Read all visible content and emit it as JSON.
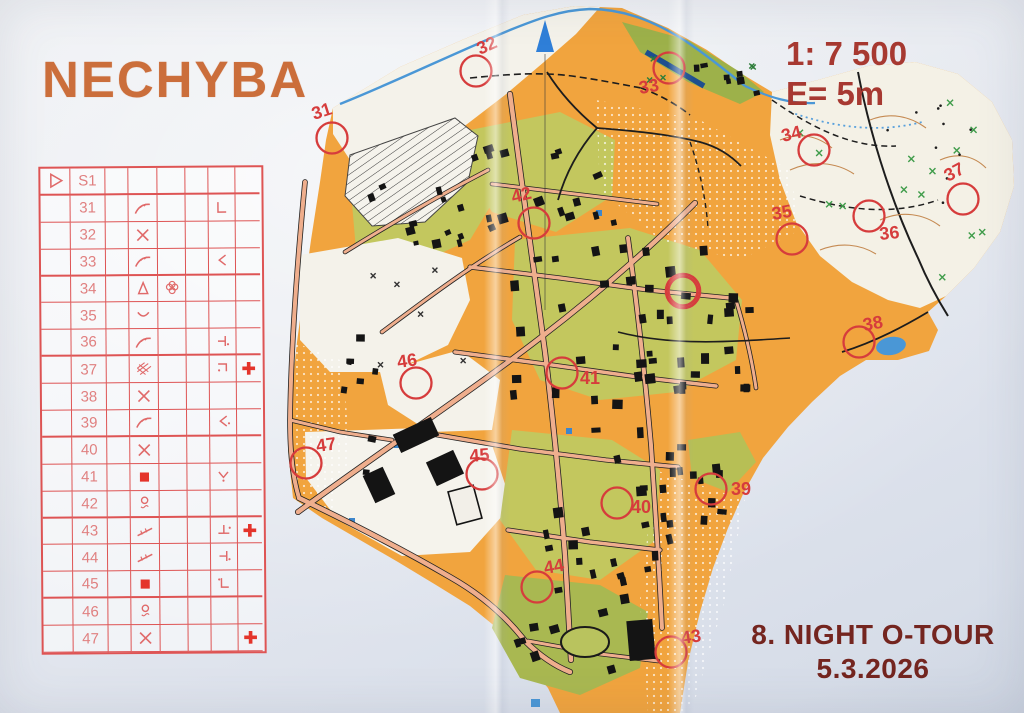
{
  "title": "NECHYBA",
  "map_info": {
    "scale": "1: 7 500",
    "contour_interval": "E= 5m"
  },
  "event": {
    "line1": "8. NIGHT O-TOUR",
    "line2": "5.3.2026"
  },
  "colors": {
    "course": "#d63c3c",
    "title": "#cb6e3b",
    "scale_text": "#a73931",
    "event_text": "#74251f",
    "sheet": "#de5454",
    "water": "#4a97d6"
  },
  "control_card": {
    "start_code": "S1",
    "start_symbol": "start-triangle",
    "rows": [
      {
        "no": "31",
        "sym_d": "earth-bank",
        "sym_e": "",
        "sym_g": "corner",
        "sym_h": ""
      },
      {
        "no": "32",
        "sym_d": "crossing",
        "sym_e": "",
        "sym_g": "",
        "sym_h": ""
      },
      {
        "no": "33",
        "sym_d": "earth-bank",
        "sym_e": "",
        "sym_g": "angle-left",
        "sym_h": ""
      },
      {
        "no": "34",
        "sym_d": "knoll",
        "sym_e": "copse",
        "sym_g": "",
        "sym_h": ""
      },
      {
        "no": "35",
        "sym_d": "depression",
        "sym_e": "",
        "sym_g": "",
        "sym_h": ""
      },
      {
        "no": "36",
        "sym_d": "earth-bank",
        "sym_e": "",
        "sym_g": "tbar-dot",
        "sym_h": ""
      },
      {
        "no": "37",
        "sym_d": "crosshatch",
        "sym_e": "",
        "sym_g": "corner-top-dot",
        "sym_h": "first-aid"
      },
      {
        "no": "38",
        "sym_d": "crossing",
        "sym_e": "",
        "sym_g": "",
        "sym_h": ""
      },
      {
        "no": "39",
        "sym_d": "earth-bank",
        "sym_e": "",
        "sym_g": "angle-left-dot",
        "sym_h": ""
      },
      {
        "no": "40",
        "sym_d": "crossing",
        "sym_e": "",
        "sym_g": "",
        "sym_h": ""
      },
      {
        "no": "41",
        "sym_d": "building",
        "sym_e": "",
        "sym_g": "vee-dot",
        "sym_h": ""
      },
      {
        "no": "42",
        "sym_d": "spring",
        "sym_e": "",
        "sym_g": "",
        "sym_h": ""
      },
      {
        "no": "43",
        "sym_d": "fence",
        "sym_e": "",
        "sym_g": "tack-up-dot",
        "sym_h": "first-aid"
      },
      {
        "no": "44",
        "sym_d": "fence",
        "sym_e": "",
        "sym_g": "tbar-dot",
        "sym_h": ""
      },
      {
        "no": "45",
        "sym_d": "building",
        "sym_e": "",
        "sym_g": "corner-left-dot",
        "sym_h": ""
      },
      {
        "no": "46",
        "sym_d": "spring",
        "sym_e": "",
        "sym_g": "",
        "sym_h": ""
      },
      {
        "no": "47",
        "sym_d": "crossing",
        "sym_e": "",
        "sym_g": "",
        "sym_h": "first-aid"
      }
    ],
    "group_breaks_after": [
      "S1",
      "33",
      "36",
      "39",
      "42",
      "45"
    ]
  },
  "map": {
    "north_arrow": "north-arrow",
    "controls": [
      {
        "n": "31",
        "cx": 332,
        "cy": 138,
        "lx": 314,
        "ly": 120,
        "rot": -18
      },
      {
        "n": "32",
        "cx": 476,
        "cy": 71,
        "lx": 480,
        "ly": 55,
        "rot": -24
      },
      {
        "n": "33",
        "cx": 669,
        "cy": 68,
        "lx": 640,
        "ly": 94,
        "rot": -10
      },
      {
        "n": "34",
        "cx": 814,
        "cy": 150,
        "lx": 783,
        "ly": 142,
        "rot": -14
      },
      {
        "n": "35",
        "cx": 792,
        "cy": 239,
        "lx": 773,
        "ly": 220,
        "rot": -10
      },
      {
        "n": "36",
        "cx": 869,
        "cy": 216,
        "lx": 880,
        "ly": 240,
        "rot": -6
      },
      {
        "n": "37",
        "cx": 963,
        "cy": 199,
        "lx": 948,
        "ly": 182,
        "rot": -28
      },
      {
        "n": "38",
        "cx": 859,
        "cy": 342,
        "lx": 864,
        "ly": 331,
        "rot": -10
      },
      {
        "n": "39",
        "cx": 711,
        "cy": 489,
        "lx": 731,
        "ly": 495,
        "rot": 0
      },
      {
        "n": "40",
        "cx": 617,
        "cy": 503,
        "lx": 631,
        "ly": 513,
        "rot": 0
      },
      {
        "n": "41",
        "cx": 562,
        "cy": 373,
        "lx": 580,
        "ly": 384,
        "rot": 0
      },
      {
        "n": "42",
        "cx": 534,
        "cy": 223,
        "lx": 513,
        "ly": 203,
        "rot": -14
      },
      {
        "n": "43",
        "cx": 671,
        "cy": 652,
        "lx": 682,
        "ly": 644,
        "rot": -8
      },
      {
        "n": "44",
        "cx": 537,
        "cy": 587,
        "lx": 545,
        "ly": 574,
        "rot": -10
      },
      {
        "n": "45",
        "cx": 482,
        "cy": 474,
        "lx": 470,
        "ly": 462,
        "rot": -5
      },
      {
        "n": "46",
        "cx": 416,
        "cy": 383,
        "lx": 398,
        "ly": 368,
        "rot": -8
      },
      {
        "n": "47",
        "cx": 306,
        "cy": 463,
        "lx": 317,
        "ly": 452,
        "rot": -8
      }
    ],
    "extra_circle": {
      "cx": 683,
      "cy": 291
    }
  }
}
